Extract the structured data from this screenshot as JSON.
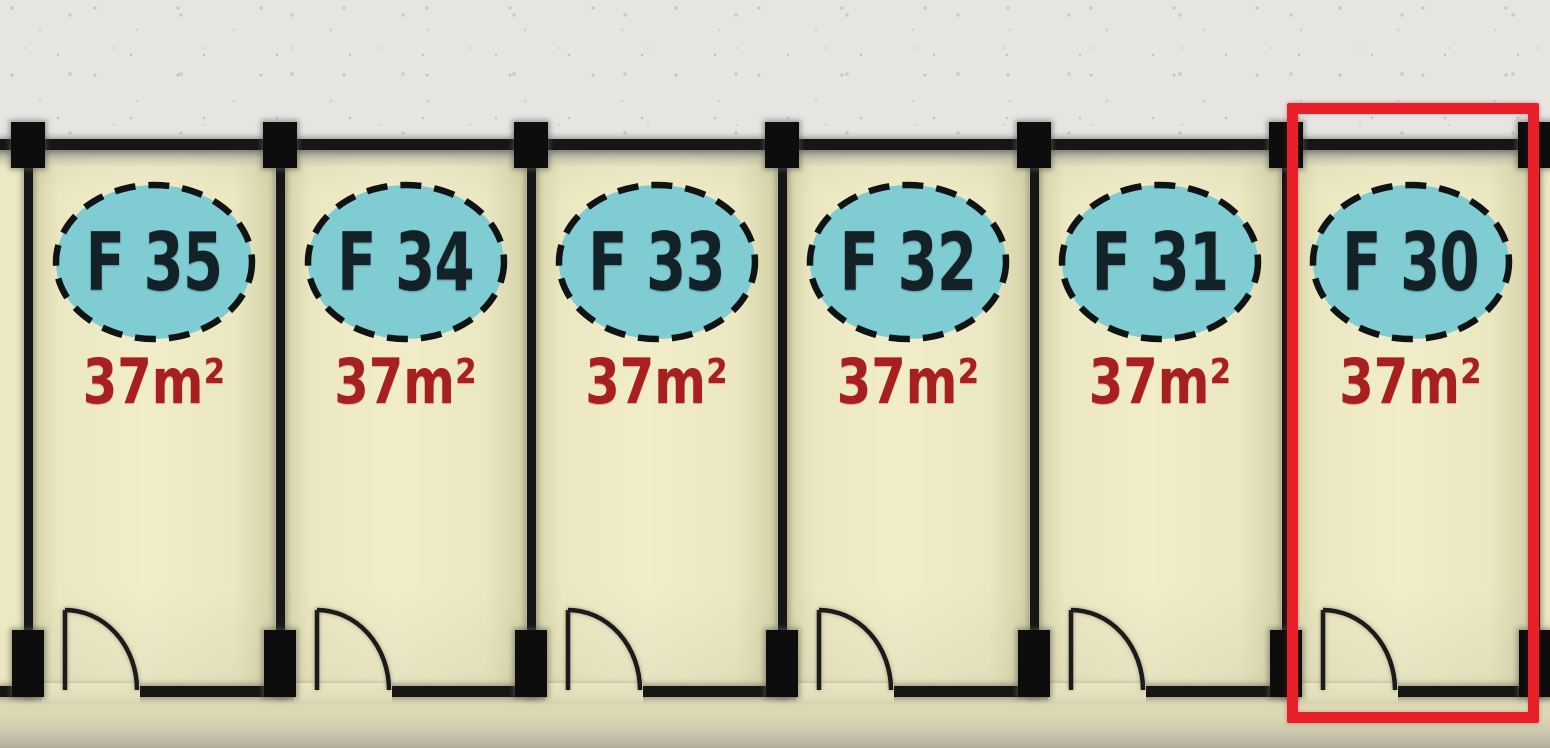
{
  "floorplan": {
    "units": [
      {
        "label": "F 35",
        "area": "37m²"
      },
      {
        "label": "F 34",
        "area": "37m²"
      },
      {
        "label": "F 33",
        "area": "37m²"
      },
      {
        "label": "F 32",
        "area": "37m²"
      },
      {
        "label": "F 31",
        "area": "37m²"
      },
      {
        "label": "F 30",
        "area": "37m²"
      }
    ],
    "highlighted_unit": "F 30",
    "colors": {
      "unit_fill": "#f1edc9",
      "badge_fill": "#7fccd2",
      "badge_text": "#132227",
      "area_text": "#a81f20",
      "wall": "#161616",
      "highlight": "#e8202a",
      "top_background": "#e6e5e2"
    }
  }
}
